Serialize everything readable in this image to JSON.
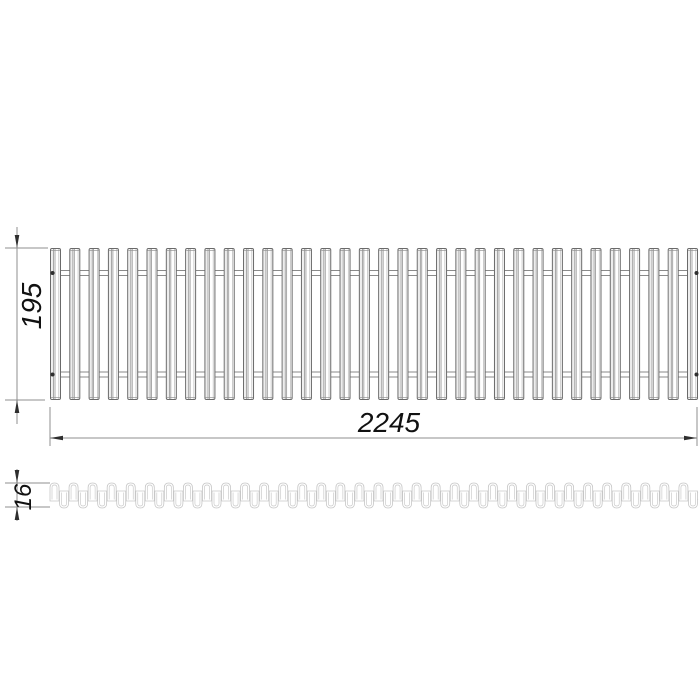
{
  "drawing": {
    "name": "roll-up grille technical drawing",
    "views": {
      "front": {
        "label": "grille front view",
        "slat_count": 34,
        "width_dim": {
          "value": "2245"
        },
        "height_dim": {
          "value": "195"
        }
      },
      "profile": {
        "label": "rolled grille side profile",
        "segment_count": 34,
        "height_dim": {
          "value": "16"
        }
      }
    },
    "colors": {
      "background": "#ffffff",
      "outline": "#6a6a6a",
      "inner_line": "#949494",
      "faint_line": "#c0c0c0",
      "shade_fill": "#ededed",
      "rod": "#8a8a8a",
      "dimension": "#8f8f8f",
      "arrow": "#2e2e2e",
      "dot": "#2f2f2f",
      "profile": "#c6c6c6"
    }
  }
}
